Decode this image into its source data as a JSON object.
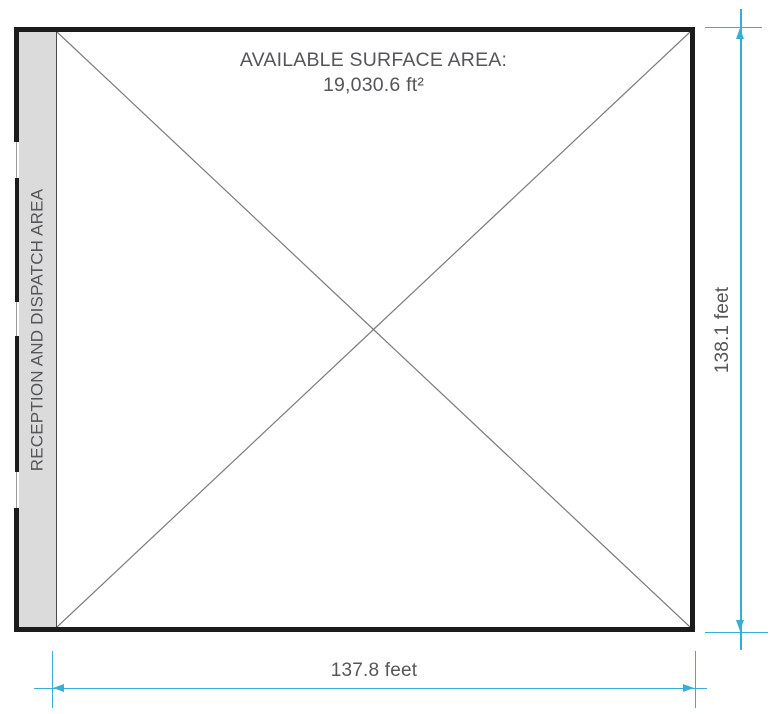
{
  "figure": {
    "title": "AVAILABLE SURFACE AREA:",
    "area_value": "19,030.6 ft²",
    "strip_label": "RECEPTION AND DISPATCH AREA",
    "dimensions": {
      "width_label": "137.8 feet",
      "height_label": "138.1 feet"
    }
  },
  "colors": {
    "wall": "#1c1c1c",
    "strip-fill": "#dbdbdb",
    "strip-border": "#4a4a4a",
    "gap-line": "#9b9b9b",
    "diagonal": "#7a7a7a",
    "dimension": "#35afd8",
    "text": "#54565a"
  }
}
